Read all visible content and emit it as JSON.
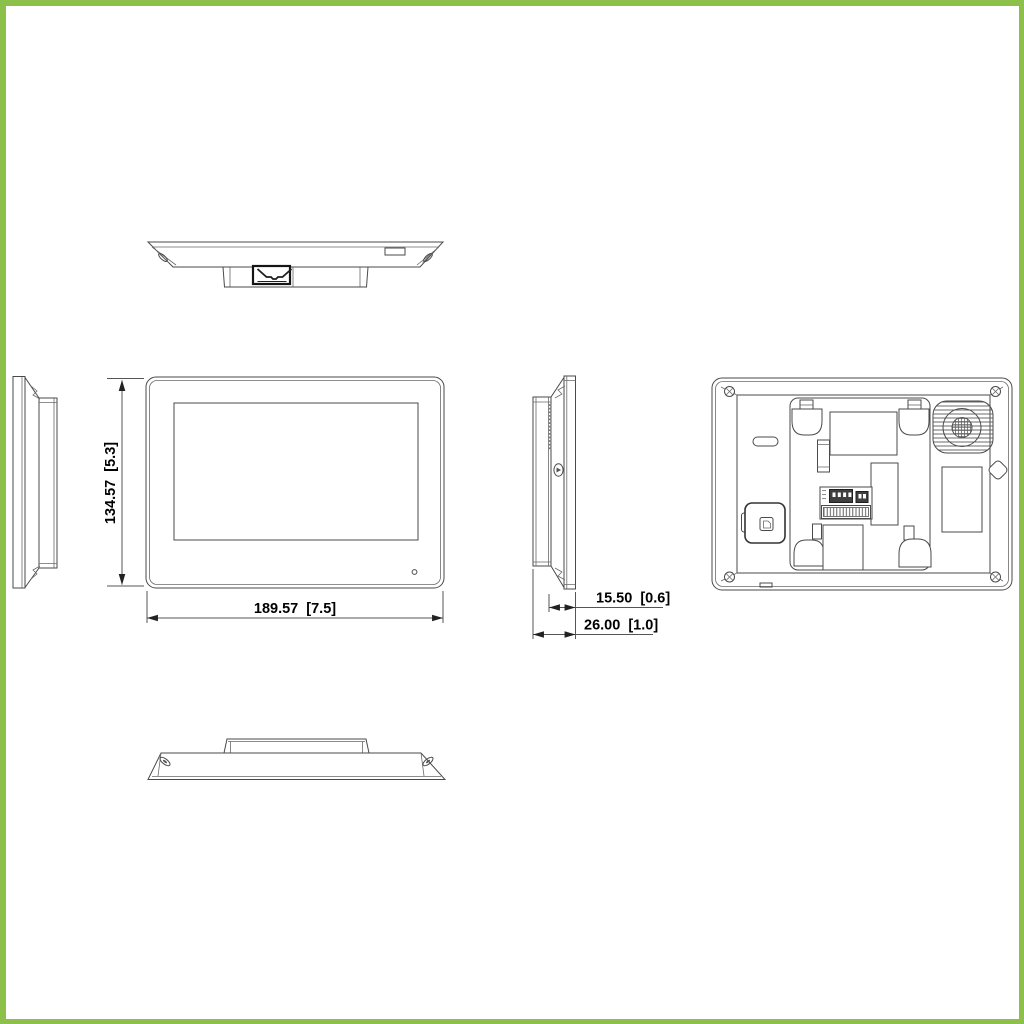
{
  "page": {
    "background": "#ffffff",
    "frame_color": "#8cc04b",
    "line_color": "#4a4a4a",
    "text_color": "#000000"
  },
  "dimensions": {
    "height": "134.57  [5.3]",
    "width": "189.57  [7.5]",
    "body_depth": "15.50  [0.6]",
    "total_depth": "26.00  [1.0]"
  }
}
